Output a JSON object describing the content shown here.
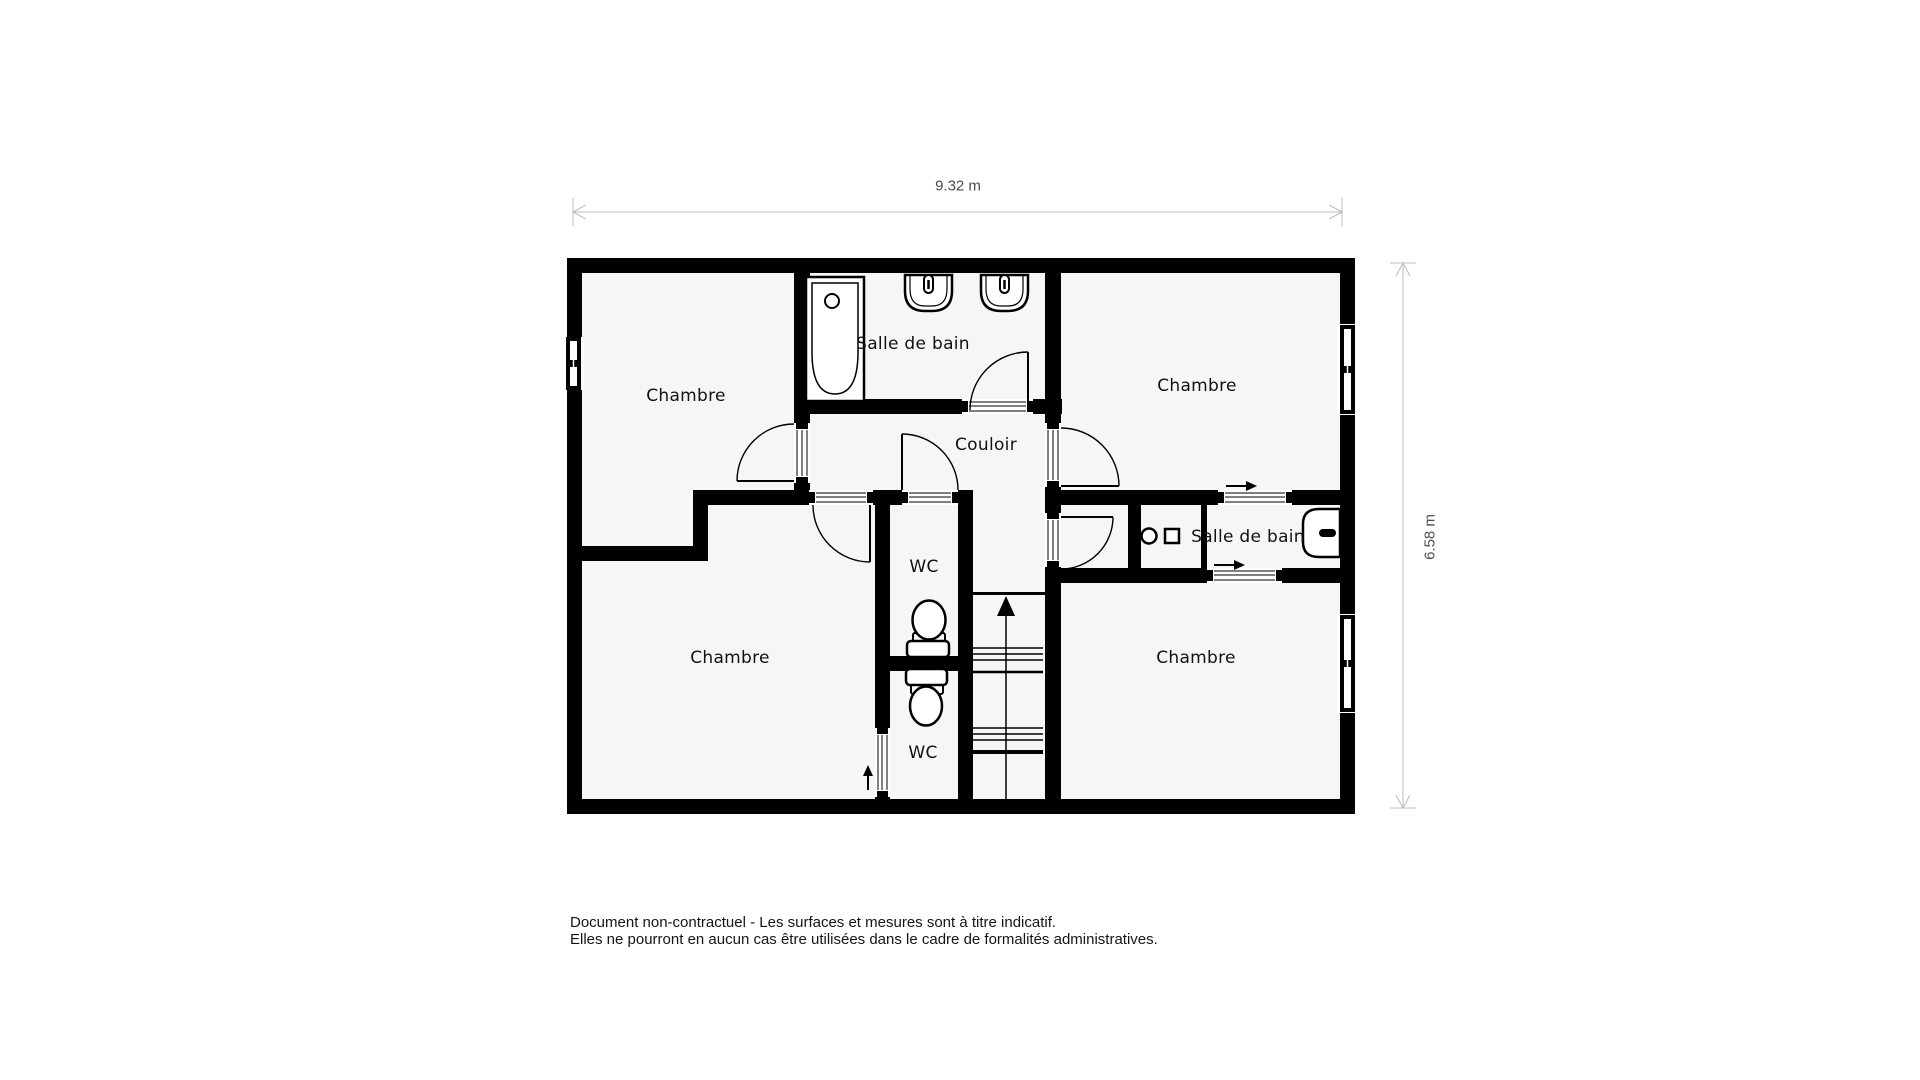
{
  "plan": {
    "title": "floor-plan",
    "rooms": [
      {
        "id": "chambre-haut-gauche",
        "label": "Chambre"
      },
      {
        "id": "salle-de-bain-haut",
        "label": "Salle de bain"
      },
      {
        "id": "chambre-haut-droite",
        "label": "Chambre"
      },
      {
        "id": "couloir",
        "label": "Couloir"
      },
      {
        "id": "wc-haut",
        "label": "WC"
      },
      {
        "id": "salle-de-bain-droite",
        "label": "Salle de bain"
      },
      {
        "id": "chambre-bas-gauche",
        "label": "Chambre"
      },
      {
        "id": "wc-bas",
        "label": "WC"
      },
      {
        "id": "chambre-bas-droite",
        "label": "Chambre"
      }
    ],
    "dimensions": {
      "width_label": "9.32 m",
      "height_label": "6.58 m"
    },
    "fixtures": [
      "bathtub-icon",
      "sink-icon",
      "sink-icon",
      "toilet-icon",
      "toilet-icon",
      "shower-icon",
      "washbasin-icon",
      "stairs-icon",
      "window-icon",
      "door-arc-icon"
    ],
    "colors": {
      "wall": "#000000",
      "floor": "#f6f6f6",
      "page": "#ffffff",
      "dimension_line": "#bdbdbd",
      "dimension_text": "#4d4d4d",
      "label_text": "#111111"
    },
    "footer": {
      "line1": "Document non-contractuel - Les surfaces et mesures sont à titre indicatif.",
      "line2": "Elles ne pourront en aucun cas être utilisées dans le cadre de formalités administratives."
    }
  }
}
